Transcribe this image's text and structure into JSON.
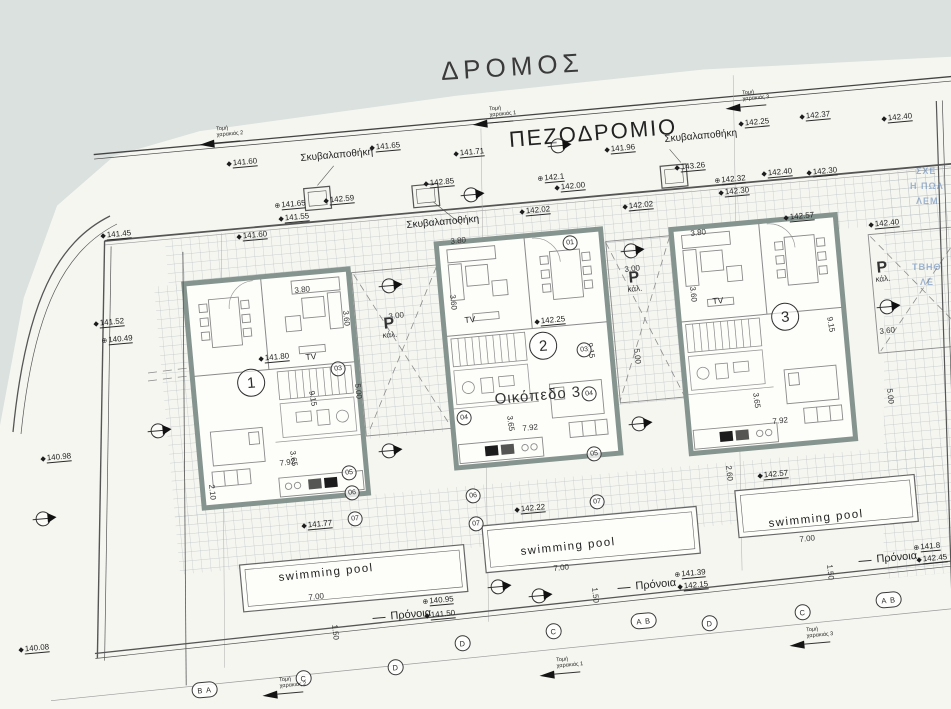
{
  "colors": {
    "paper": "#f6f6f1",
    "road_bg": "#dbe1de",
    "wall": "#86948f",
    "line": "#555555",
    "hatch": "#bcc5c6",
    "bleed_blue": "#557db4"
  },
  "titles": {
    "road": "ΔΡΟΜΟΣ",
    "sidewalk": "ΠΕΖΟΔΡΟΜΙΟ",
    "plot": "Οικόπεδο 3"
  },
  "units": [
    {
      "n": "1",
      "x": 236,
      "y": 370
    },
    {
      "n": "2",
      "x": 528,
      "y": 333
    },
    {
      "n": "3",
      "x": 770,
      "y": 304
    }
  ],
  "parking_labels": [
    {
      "p": "P",
      "sub": "κάλ.",
      "x": 381,
      "y": 318
    },
    {
      "p": "P",
      "sub": "κάλ.",
      "x": 626,
      "y": 272
    },
    {
      "p": "P",
      "sub": "κάλ.",
      "x": 874,
      "y": 262
    }
  ],
  "tv_labels": [
    {
      "t": "TV",
      "x": 305,
      "y": 352
    },
    {
      "t": "TV",
      "x": 464,
      "y": 315
    },
    {
      "t": "TV",
      "x": 712,
      "y": 296
    }
  ],
  "pool_labels": [
    {
      "t": "swimming pool",
      "x": 278,
      "y": 572,
      "r": -6
    },
    {
      "t": "swimming pool",
      "x": 520,
      "y": 546,
      "r": -6
    },
    {
      "t": "swimming pool",
      "x": 768,
      "y": 518,
      "r": -6
    }
  ],
  "pronoia_labels": [
    {
      "t": "Πρόνοια",
      "x": 372,
      "y": 612
    },
    {
      "t": "Πρόνοια",
      "x": 617,
      "y": 582
    },
    {
      "t": "Πρόνοια",
      "x": 858,
      "y": 555
    }
  ],
  "garbage_labels": [
    {
      "t": "Σκυβαλαποθήκη",
      "x": 300,
      "y": 153
    },
    {
      "t": "Σκυβαλαποθήκη",
      "x": 406,
      "y": 220
    },
    {
      "t": "Σκυβαλαποθήκη",
      "x": 664,
      "y": 134
    }
  ],
  "spot_elevations": [
    {
      "v": "141.45",
      "x": 100,
      "y": 231,
      "s": "◆"
    },
    {
      "v": "141.60",
      "x": 226,
      "y": 159,
      "s": "◆"
    },
    {
      "v": "141.65",
      "x": 274,
      "y": 201,
      "s": "⊕"
    },
    {
      "v": "141.55",
      "x": 278,
      "y": 214,
      "s": "◆"
    },
    {
      "v": "141.60",
      "x": 236,
      "y": 232,
      "s": "◆"
    },
    {
      "v": "142.59",
      "x": 323,
      "y": 196,
      "s": "◆"
    },
    {
      "v": "141.65",
      "x": 369,
      "y": 143,
      "s": "◆"
    },
    {
      "v": "142.85",
      "x": 423,
      "y": 179,
      "s": "◆"
    },
    {
      "v": "141.71",
      "x": 453,
      "y": 149,
      "s": "◆"
    },
    {
      "v": "141.96",
      "x": 604,
      "y": 145,
      "s": "◆"
    },
    {
      "v": "142.1",
      "x": 537,
      "y": 174,
      "s": "⊕"
    },
    {
      "v": "142.00",
      "x": 554,
      "y": 183,
      "s": "◆"
    },
    {
      "v": "142.02",
      "x": 519,
      "y": 207,
      "s": "◆"
    },
    {
      "v": "142.02",
      "x": 622,
      "y": 202,
      "s": "◆"
    },
    {
      "v": "142.25",
      "x": 738,
      "y": 119,
      "s": "◆"
    },
    {
      "v": "142.37",
      "x": 799,
      "y": 112,
      "s": "◆"
    },
    {
      "v": "142.40",
      "x": 881,
      "y": 114,
      "s": "◆"
    },
    {
      "v": "143.26",
      "x": 674,
      "y": 163,
      "s": "◆"
    },
    {
      "v": "142.32",
      "x": 714,
      "y": 176,
      "s": "⊕"
    },
    {
      "v": "142.30",
      "x": 718,
      "y": 188,
      "s": "◆"
    },
    {
      "v": "142.40",
      "x": 761,
      "y": 169,
      "s": "◆"
    },
    {
      "v": "142.30",
      "x": 806,
      "y": 168,
      "s": "◆"
    },
    {
      "v": "142.57",
      "x": 783,
      "y": 213,
      "s": "◆"
    },
    {
      "v": "142.40",
      "x": 868,
      "y": 220,
      "s": "◆"
    },
    {
      "v": "141.52",
      "x": 93,
      "y": 319,
      "s": "◆"
    },
    {
      "v": "140.49",
      "x": 101,
      "y": 336,
      "s": "⊕"
    },
    {
      "v": "140.98",
      "x": 40,
      "y": 454,
      "s": "◆"
    },
    {
      "v": "141.80",
      "x": 258,
      "y": 354,
      "s": "◆"
    },
    {
      "v": "142.25",
      "x": 534,
      "y": 317,
      "s": "◆"
    },
    {
      "v": "141.77",
      "x": 301,
      "y": 521,
      "s": "◆"
    },
    {
      "v": "140.95",
      "x": 422,
      "y": 597,
      "s": "⊕"
    },
    {
      "v": "141.50",
      "x": 424,
      "y": 611,
      "s": "◆"
    },
    {
      "v": "142.22",
      "x": 514,
      "y": 505,
      "s": "◆"
    },
    {
      "v": "141.39",
      "x": 674,
      "y": 570,
      "s": "⊕"
    },
    {
      "v": "142.15",
      "x": 677,
      "y": 582,
      "s": "◆"
    },
    {
      "v": "142.57",
      "x": 757,
      "y": 471,
      "s": "◆"
    },
    {
      "v": "141.8",
      "x": 913,
      "y": 543,
      "s": "⊕"
    },
    {
      "v": "142.45",
      "x": 916,
      "y": 555,
      "s": "◆"
    },
    {
      "v": "140.08",
      "x": 18,
      "y": 645,
      "s": "◆"
    }
  ],
  "dims": [
    {
      "v": "3.80",
      "x": 294,
      "y": 286,
      "r": -6
    },
    {
      "v": "3.60",
      "x": 350,
      "y": 310,
      "r": 84
    },
    {
      "v": "9.15",
      "x": 316,
      "y": 390,
      "r": 80
    },
    {
      "v": "7.92",
      "x": 279,
      "y": 459,
      "r": -8
    },
    {
      "v": "3.65",
      "x": 297,
      "y": 450,
      "r": 82
    },
    {
      "v": "2.10",
      "x": 216,
      "y": 484,
      "r": 84
    },
    {
      "v": "3.80",
      "x": 450,
      "y": 237,
      "r": -6
    },
    {
      "v": "3.60",
      "x": 457,
      "y": 294,
      "r": 84
    },
    {
      "v": "9.15",
      "x": 594,
      "y": 342,
      "r": 80
    },
    {
      "v": "7.92",
      "x": 522,
      "y": 424,
      "r": -6
    },
    {
      "v": "3.65",
      "x": 514,
      "y": 415,
      "r": 82
    },
    {
      "v": "3.80",
      "x": 690,
      "y": 229,
      "r": -6
    },
    {
      "v": "3.60",
      "x": 697,
      "y": 286,
      "r": 84
    },
    {
      "v": "9.15",
      "x": 834,
      "y": 316,
      "r": 80
    },
    {
      "v": "7.92",
      "x": 772,
      "y": 417,
      "r": -6
    },
    {
      "v": "3.65",
      "x": 760,
      "y": 392,
      "r": 82
    },
    {
      "v": "3.00",
      "x": 388,
      "y": 312,
      "r": -6
    },
    {
      "v": "5.00",
      "x": 362,
      "y": 383,
      "r": 84
    },
    {
      "v": "3.00",
      "x": 624,
      "y": 265,
      "r": -6
    },
    {
      "v": "5.00",
      "x": 641,
      "y": 348,
      "r": 84
    },
    {
      "v": "3.60",
      "x": 879,
      "y": 327,
      "r": -6
    },
    {
      "v": "5.00",
      "x": 894,
      "y": 388,
      "r": 84
    },
    {
      "v": "7.00",
      "x": 308,
      "y": 593,
      "r": -6
    },
    {
      "v": "1.50",
      "x": 339,
      "y": 624,
      "r": 84
    },
    {
      "v": "7.00",
      "x": 553,
      "y": 564,
      "r": -6
    },
    {
      "v": "1.50",
      "x": 599,
      "y": 587,
      "r": 84
    },
    {
      "v": "7.00",
      "x": 799,
      "y": 535,
      "r": -6
    },
    {
      "v": "1.50",
      "x": 834,
      "y": 564,
      "r": 84
    },
    {
      "v": "2.60",
      "x": 733,
      "y": 465,
      "r": 84
    }
  ],
  "room_tags": [
    {
      "n": "03",
      "x": 330,
      "y": 362
    },
    {
      "n": "05",
      "x": 341,
      "y": 466
    },
    {
      "n": "06",
      "x": 344,
      "y": 486
    },
    {
      "n": "07",
      "x": 347,
      "y": 512
    },
    {
      "n": "01",
      "x": 562,
      "y": 236
    },
    {
      "n": "03",
      "x": 576,
      "y": 343
    },
    {
      "n": "04",
      "x": 456,
      "y": 411
    },
    {
      "n": "04",
      "x": 581,
      "y": 387
    },
    {
      "n": "05",
      "x": 586,
      "y": 447
    },
    {
      "n": "06",
      "x": 465,
      "y": 489
    },
    {
      "n": "07",
      "x": 468,
      "y": 517
    },
    {
      "n": "07",
      "x": 589,
      "y": 495
    }
  ],
  "grid_bubbles": [
    {
      "t": "B A",
      "x": 191,
      "y": 683,
      "w": 24
    },
    {
      "t": "C",
      "x": 295,
      "y": 671,
      "w": 14
    },
    {
      "t": "D",
      "x": 387,
      "y": 660,
      "w": 14
    },
    {
      "t": "D",
      "x": 454,
      "y": 636,
      "w": 14
    },
    {
      "t": "C",
      "x": 545,
      "y": 624,
      "w": 14
    },
    {
      "t": "A B",
      "x": 630,
      "y": 614,
      "w": 24
    },
    {
      "t": "D",
      "x": 701,
      "y": 616,
      "w": 14
    },
    {
      "t": "C",
      "x": 794,
      "y": 605,
      "w": 14
    },
    {
      "t": "A B",
      "x": 875,
      "y": 593,
      "w": 24
    }
  ],
  "section_cuts": [
    {
      "t": "Τομή\nχαρακιάς 2",
      "x": 198,
      "y": 128
    },
    {
      "t": "Τομή\nχαρακιάς 1",
      "x": 471,
      "y": 108
    },
    {
      "t": "Τομή\nχαρακιάς 3",
      "x": 724,
      "y": 92
    },
    {
      "t": "Τομή\nχαρακιάς 2",
      "x": 261,
      "y": 679
    },
    {
      "t": "Τομή\nχαρακιάς 1",
      "x": 538,
      "y": 659
    },
    {
      "t": "Τομή\nχαρακιάς 3",
      "x": 788,
      "y": 629
    }
  ],
  "level_markers": [
    {
      "x": 550,
      "y": 139
    },
    {
      "x": 463,
      "y": 188
    },
    {
      "x": 381,
      "y": 279
    },
    {
      "x": 381,
      "y": 444
    },
    {
      "x": 623,
      "y": 244
    },
    {
      "x": 631,
      "y": 417
    },
    {
      "x": 879,
      "y": 300
    },
    {
      "x": 35,
      "y": 512
    },
    {
      "x": 150,
      "y": 424
    },
    {
      "x": 490,
      "y": 580
    },
    {
      "x": 531,
      "y": 589
    }
  ],
  "bleed_text": [
    {
      "t": "ΣΧΕ",
      "x": 916,
      "y": 166,
      "r": 0
    },
    {
      "t": "Η ΠΩΛ",
      "x": 910,
      "y": 181,
      "r": 0
    },
    {
      "t": "ΛΕΜ",
      "x": 916,
      "y": 196,
      "r": 0
    },
    {
      "t": "ΤΒΗΘ",
      "x": 912,
      "y": 262,
      "r": 0
    },
    {
      "t": "ΛΕ",
      "x": 920,
      "y": 277,
      "r": 0
    }
  ]
}
